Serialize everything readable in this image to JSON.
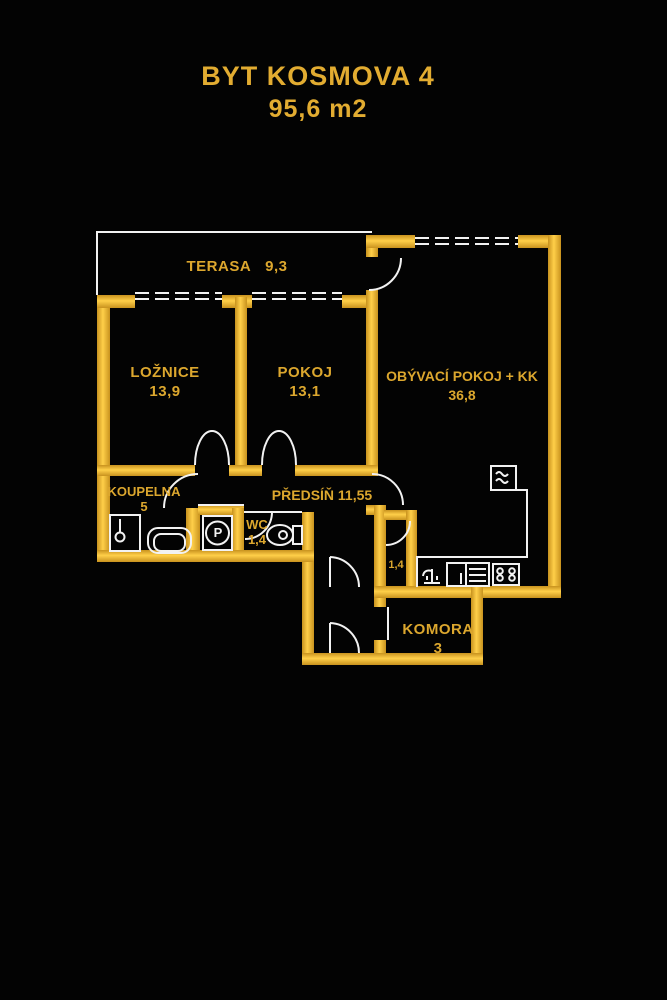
{
  "title": {
    "line1": "BYT KOSMOVA 4",
    "line2": "95,6 m2"
  },
  "rooms": {
    "terasa": {
      "name": "TERASA",
      "area": "9,3"
    },
    "loznice": {
      "name": "LOŽNICE",
      "area": "13,9"
    },
    "pokoj": {
      "name": "POKOJ",
      "area": "13,1"
    },
    "obyvaci": {
      "name": "OBÝVACÍ POKOJ + KK",
      "area": "36,8"
    },
    "koupelna": {
      "name": "KOUPELNA",
      "area": "5"
    },
    "predsin": {
      "name": "PŘEDSÍŇ",
      "area": "11,55"
    },
    "wc": {
      "name": "WC",
      "area": "1,4"
    },
    "satna": {
      "area": "1,4"
    },
    "komora": {
      "name": "KOMORA",
      "area": "3"
    }
  },
  "fixtures": {
    "washer_letter": "P"
  },
  "colors": {
    "background": "#030303",
    "wall_core": "#ffcf49",
    "wall_edge": "#c8921e",
    "label_text": "#dca72e",
    "title_text": "#e2ac31",
    "linework": "#f2f2f2"
  }
}
